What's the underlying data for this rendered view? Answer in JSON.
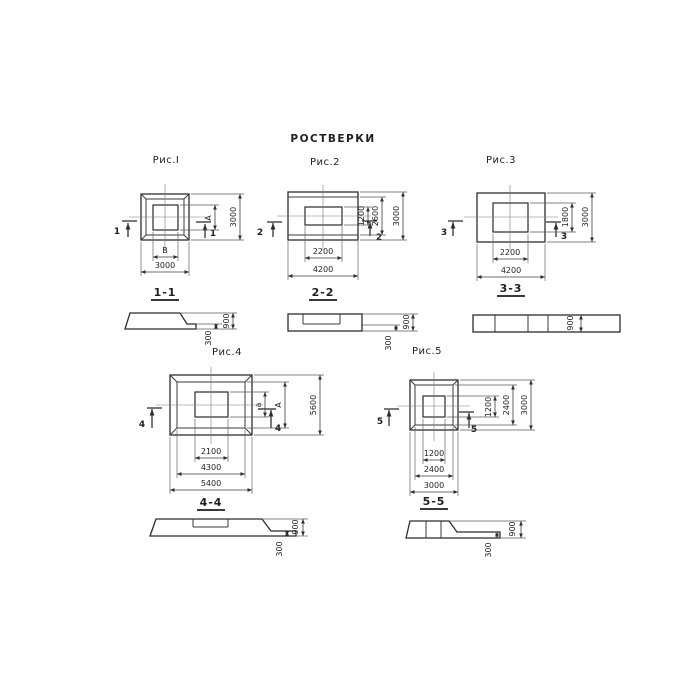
{
  "title": "РОСТВЕРКИ",
  "colors": {
    "line": "#3a3a3a",
    "background": "#ffffff",
    "text": "#1f1f1f"
  },
  "fig1": {
    "label": "Рис.I",
    "cut": "1",
    "plan": {
      "inner_width": "В",
      "outer_width": "3000",
      "inner_height": "А",
      "outer_height": "3000"
    },
    "section": {
      "label": "1-1",
      "height": "900",
      "ledge": "300"
    }
  },
  "fig2": {
    "label": "Рис.2",
    "cut": "2",
    "plan": {
      "inner_width": "2200",
      "outer_width": "4200",
      "inner_height": "1200",
      "mid_height": "2600",
      "outer_height": "3000"
    },
    "section": {
      "label": "2-2",
      "height": "900",
      "ledge": "300"
    }
  },
  "fig3": {
    "label": "Рис.3",
    "cut": "3",
    "plan": {
      "inner_width": "2200",
      "outer_width": "4200",
      "inner_height": "1800",
      "outer_height": "3000"
    },
    "section": {
      "label": "3-3",
      "height": "900"
    }
  },
  "fig4": {
    "label": "Рис.4",
    "cut": "4",
    "plan": {
      "inner_width": "2100",
      "mid_width": "4300",
      "outer_width": "5400",
      "inner_height": "а",
      "mid_height": "А",
      "outer_height": "5600"
    },
    "section": {
      "label": "4-4",
      "height": "900",
      "ledge": "300"
    }
  },
  "fig5": {
    "label": "Рис.5",
    "cut": "5",
    "plan": {
      "inner_width": "1200",
      "mid_width": "2400",
      "outer_width": "3000",
      "inner_height": "1200",
      "mid_height": "2400",
      "outer_height": "3000"
    },
    "section": {
      "label": "5-5",
      "height": "900",
      "ledge": "300"
    }
  }
}
